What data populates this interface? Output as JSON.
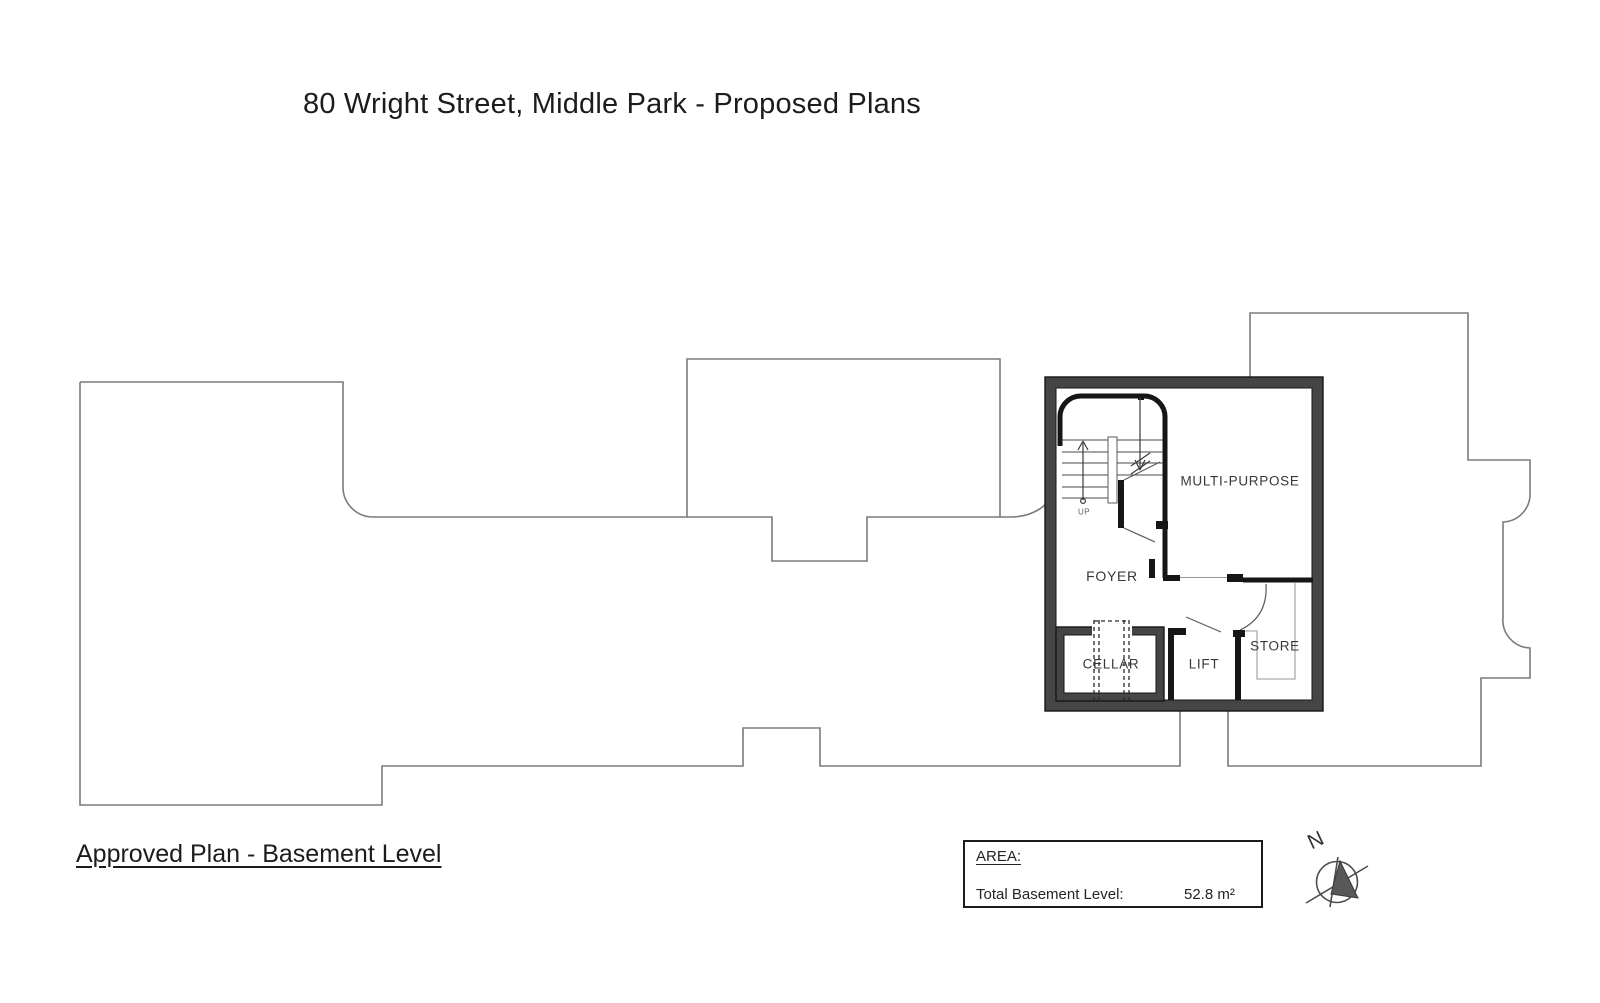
{
  "title": "80 Wright Street, Middle Park - Proposed Plans",
  "plan_caption": "Approved Plan - Basement Level",
  "rooms": {
    "multi_purpose": "MULTI-PURPOSE",
    "foyer": "FOYER",
    "cellar": "CELLAR",
    "lift": "LIFT",
    "store": "STORE",
    "stair_direction": "UP"
  },
  "area_box": {
    "heading": "AREA:",
    "total_label": "Total Basement Level:",
    "total_value": "52.8 m²"
  },
  "compass": {
    "north": "N"
  },
  "colors": {
    "outline": "#7b7b7b",
    "wall_fill": "#454545",
    "wall_edge": "#161616"
  }
}
